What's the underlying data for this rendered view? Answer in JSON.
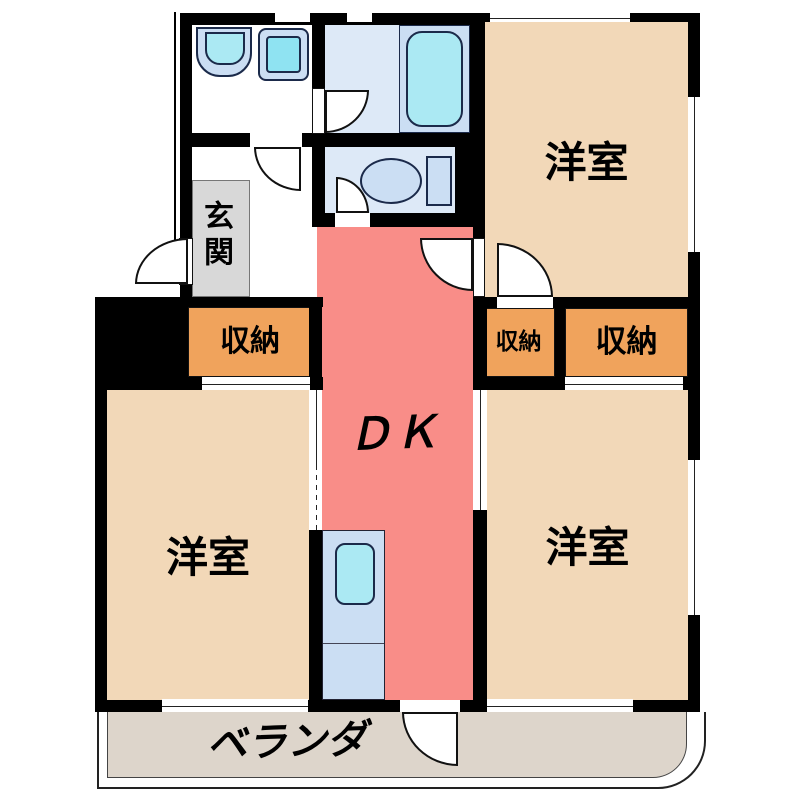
{
  "plan": {
    "rooms": {
      "western_top_right": {
        "label": "洋室"
      },
      "western_bottom_left": {
        "label": "洋室"
      },
      "western_bottom_right": {
        "label": "洋室"
      },
      "dining_kitchen": {
        "label": "ＤＫ"
      },
      "entrance": {
        "label": "玄関"
      },
      "storage_hall": {
        "label": "収納"
      },
      "storage_small": {
        "label": "収納"
      },
      "storage_large": {
        "label": "収納"
      },
      "veranda": {
        "label": "ベランダ"
      }
    },
    "fixtures": {
      "bathtub": "bathtub",
      "toilet": "toilet",
      "vanity_sink": "vanity-sink",
      "washing_machine": "washing-machine",
      "kitchen_sink": "kitchen-sink"
    },
    "colors": {
      "wall": "#000000",
      "room-tan": "#f2d8b8",
      "dk-red": "#f98d88",
      "storage-orange": "#f0a35c",
      "veranda-gray": "#ddd5cb",
      "entrance-gray": "#d8d8d8",
      "wet-floor": "#dde9f7",
      "fixture-blue": "#cbdef3",
      "fixture-cyan": "#abe9f3",
      "washer-cyan": "#8fe3f2"
    }
  }
}
